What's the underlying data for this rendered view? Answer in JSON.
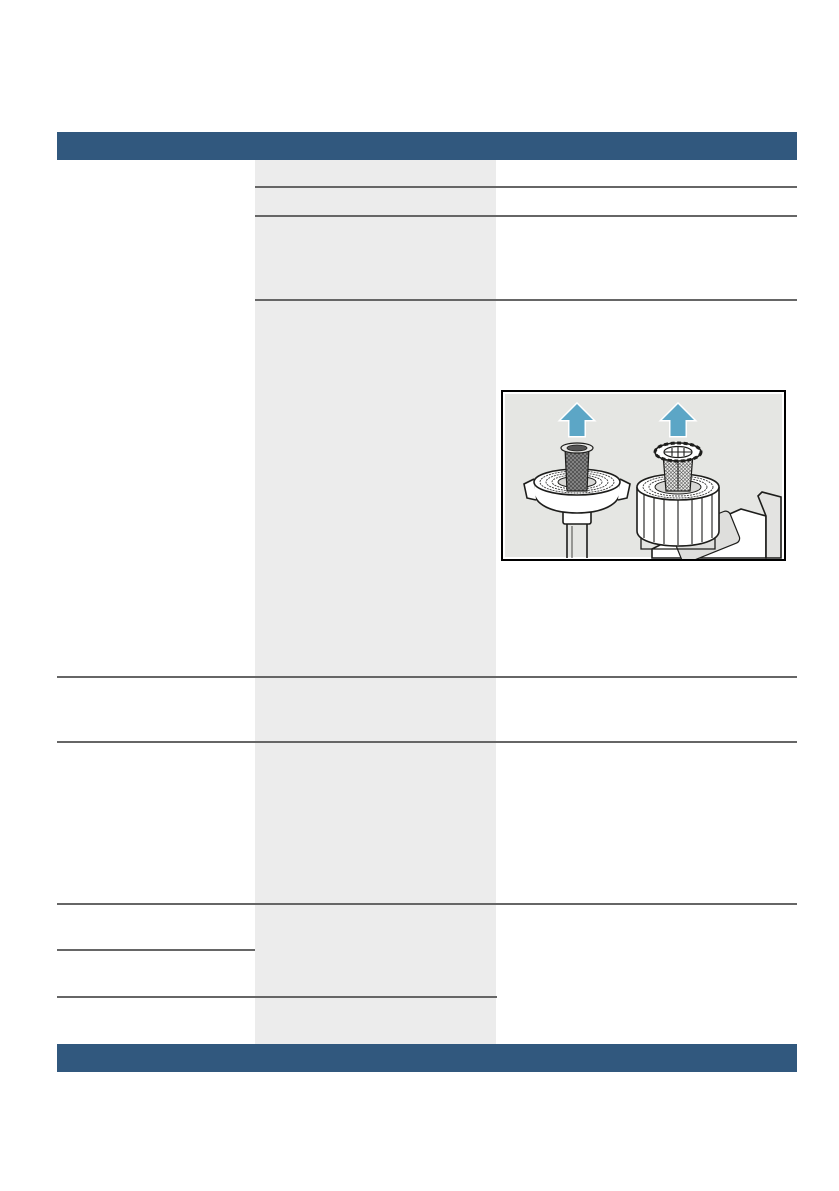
{
  "page": {
    "kind": "appliance-manual-page",
    "visible_text": []
  },
  "colors": {
    "page-bg": "#FFFFFF",
    "band-blue": "#31587E",
    "rule-gray": "#666666",
    "column-gray": "#ECECEC",
    "figure-bg": "#E5E6E3",
    "arrow-teal": "#5CA6C6",
    "lineart-stroke": "#1D1D1B"
  },
  "figure": {
    "label": "water-inlet-filter-removal-illustration",
    "panels": [
      {
        "icon": "hose-union-nut-with-mesh-filter-icon",
        "arrow": "arrow-up-icon"
      },
      {
        "icon": "aquastop-valve-with-strainer-icon",
        "arrow": "arrow-up-icon"
      }
    ]
  }
}
